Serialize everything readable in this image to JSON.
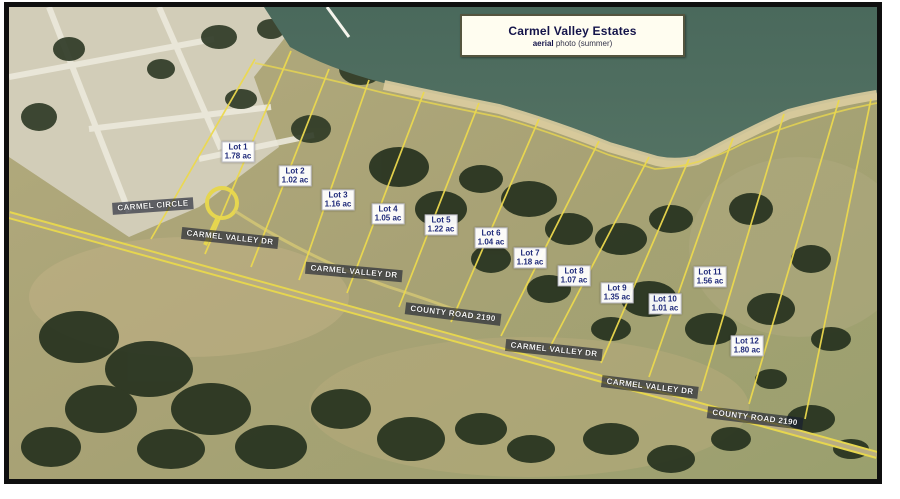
{
  "title_box": {
    "title": "Carmel Valley Estates",
    "subtitle_bold": "aerial",
    "subtitle_rest": " photo (summer)"
  },
  "colors": {
    "lake": "#4d6c5f",
    "shore_sand": "#dbcda0",
    "terrain": "#aba578",
    "developed_area": "#d2cdb8",
    "tree": "#26321f",
    "lot_line_yellow": "#ecd94e",
    "road_yellow": "#e6d64f",
    "frame_black": "#0f0f0f",
    "lot_label_text": "#1f2a7a",
    "road_label_bg": "rgba(22,28,48,0.62)"
  },
  "lots": [
    {
      "name": "Lot 1",
      "area": "1.78 ac",
      "x": 229,
      "y": 145
    },
    {
      "name": "Lot 2",
      "area": "1.02 ac",
      "x": 286,
      "y": 169
    },
    {
      "name": "Lot 3",
      "area": "1.16 ac",
      "x": 329,
      "y": 193
    },
    {
      "name": "Lot 4",
      "area": "1.05 ac",
      "x": 379,
      "y": 207
    },
    {
      "name": "Lot 5",
      "area": "1.22 ac",
      "x": 432,
      "y": 218
    },
    {
      "name": "Lot 6",
      "area": "1.04 ac",
      "x": 482,
      "y": 231
    },
    {
      "name": "Lot 7",
      "area": "1.18 ac",
      "x": 521,
      "y": 251
    },
    {
      "name": "Lot 8",
      "area": "1.07 ac",
      "x": 565,
      "y": 269
    },
    {
      "name": "Lot 9",
      "area": "1.35 ac",
      "x": 608,
      "y": 286
    },
    {
      "name": "Lot 10",
      "area": "1.01 ac",
      "x": 656,
      "y": 297
    },
    {
      "name": "Lot 11",
      "area": "1.56 ac",
      "x": 701,
      "y": 270
    },
    {
      "name": "Lot 12",
      "area": "1.80 ac",
      "x": 738,
      "y": 339
    }
  ],
  "road_labels": [
    {
      "label": "CARMEL CIRCLE",
      "x": 144,
      "y": 199,
      "angle": -4
    },
    {
      "label": "CARMEL VALLEY DR",
      "x": 221,
      "y": 231,
      "angle": 6
    },
    {
      "label": "CARMEL VALLEY DR",
      "x": 345,
      "y": 265,
      "angle": 5
    },
    {
      "label": "COUNTY ROAD 2190",
      "x": 444,
      "y": 307,
      "angle": 7
    },
    {
      "label": "CARMEL VALLEY DR",
      "x": 545,
      "y": 343,
      "angle": 6
    },
    {
      "label": "CARMEL VALLEY DR",
      "x": 641,
      "y": 380,
      "angle": 7
    },
    {
      "label": "COUNTY ROAD 2190",
      "x": 746,
      "y": 411,
      "angle": 7
    }
  ]
}
